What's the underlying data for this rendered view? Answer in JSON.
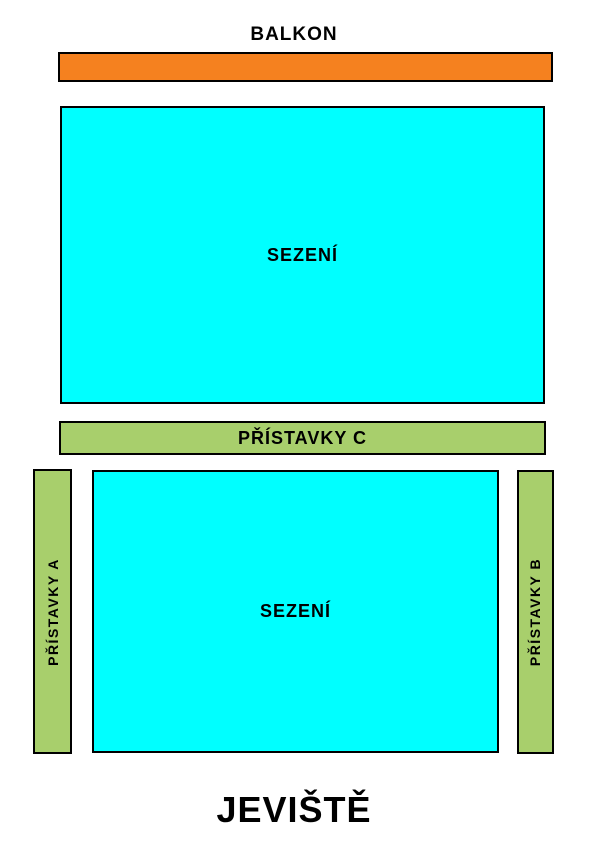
{
  "map": {
    "balcony_label": "BALKON",
    "stage_label": "JEVIŠTĚ",
    "balcony_section": {
      "color": "#F5811F"
    },
    "upper_seating": {
      "label": "SEZENÍ",
      "color": "#00FFFF"
    },
    "annex_c": {
      "label": "PŘÍSTAVKY C",
      "color": "#A8CF6C"
    },
    "annex_a": {
      "label": "PŘÍSTAVKY A",
      "color": "#A8CF6C"
    },
    "annex_b": {
      "label": "PŘÍSTAVKY B",
      "color": "#A8CF6C"
    },
    "lower_seating": {
      "label": "SEZENÍ",
      "color": "#00FFFF"
    },
    "outline_color": "#000000",
    "background_color": "#FFFFFF"
  }
}
